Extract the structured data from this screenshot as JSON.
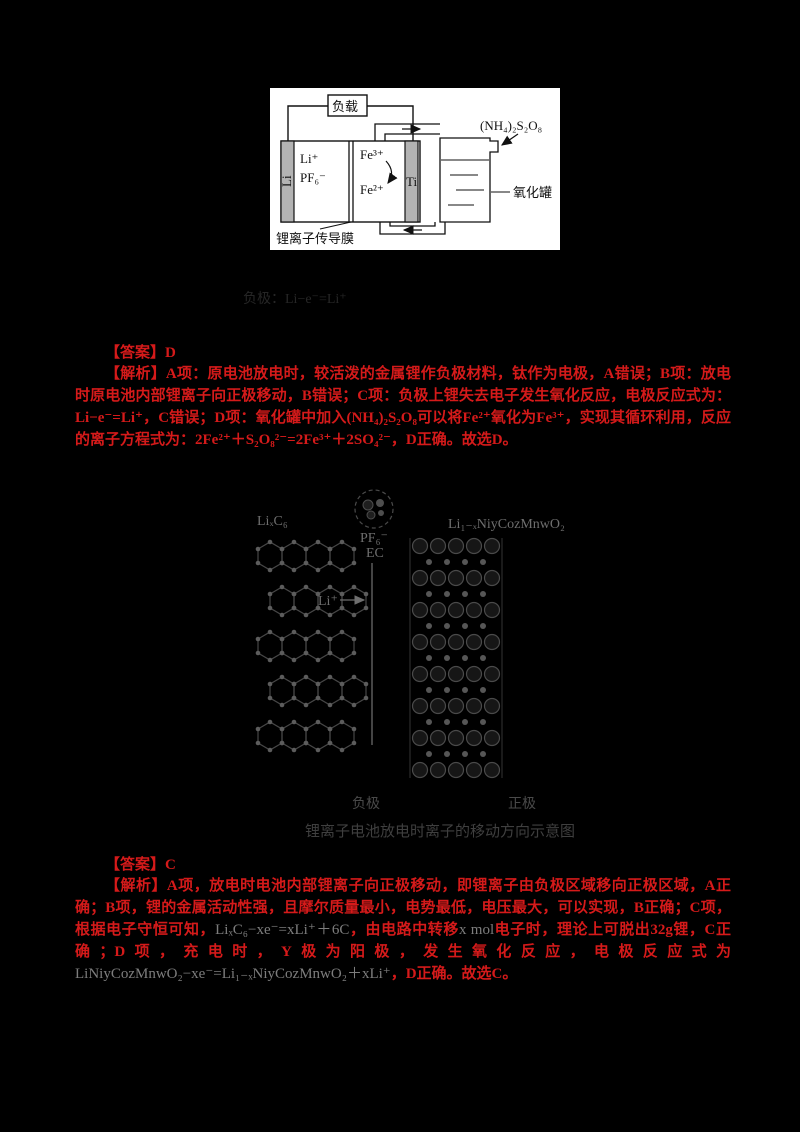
{
  "battery_diagram": {
    "load_label": "负载",
    "left_electrode": "Li",
    "electrolyte_line1": "Li⁺",
    "electrolyte_line2": "PF₆⁻",
    "catholyte_top": "Fe³⁺",
    "catholyte_bottom": "Fe²⁺",
    "right_electrode": "Ti",
    "membrane_label": "锂离子传导膜",
    "tank_label": "氧化罐",
    "oxidant_label": "(NH₄)₂S₂O₈"
  },
  "faint_equation": "负极：Li−e⁻=Li⁺",
  "answer1": {
    "label": "【答案】D",
    "analysis": "【解析】A项：原电池放电时，较活泼的金属锂作负极材料，钛作为电极，A错误；B项：放电时原电池内部锂离子向正极移动，B错误；C项：负极上锂失去电子发生氧化反应，电极反应式为：Li−e⁻=Li⁺，C错误；D项：氧化罐中加入(NH₄)₂S₂O₈可以将Fe²⁺氧化为Fe³⁺，实现其循环利用，反应的离子方程式为：2Fe²⁺＋S₂O₈²⁻=2Fe³⁺＋2SO₄²⁻，D正确。故选D。"
  },
  "figure": {
    "anode_formula": "LiₓC₆",
    "cathode_formula": "Li₁₋ₓNiyCozMnwO₂",
    "solvated_label1": "PF₆⁻",
    "solvated_label2": "EC",
    "li_ion_label": "Li⁺",
    "anode_label": "负极",
    "cathode_label": "正极",
    "caption": "锂离子电池放电时离子的移动方向示意图"
  },
  "answer2": {
    "label": "【答案】C",
    "seg1": "【解析】A项，放电时电池内部锂离子向正极移动，即锂离子由负极区域移向正极区域，A正确；B项，锂的金属活动性强，且摩尔质量最小，电势最低，电压最大，可以实现，B正确；C项，根据电子守恒可知，",
    "seg2": "LiₓC₆−xe⁻=xLi⁺＋6C",
    "seg3": "，由电路中转移",
    "seg4": "x mol",
    "seg5": "电子时，理论上可脱出32g锂，C正确；D项，充电时，Y极为阳极，发生氧化反应，电极反应式为",
    "seg6": "LiNiyCozMnwO₂−xe⁻=Li₁₋ₓNiyCozMnwO₂＋xLi⁺",
    "seg7": "，D正确。故选C。"
  }
}
